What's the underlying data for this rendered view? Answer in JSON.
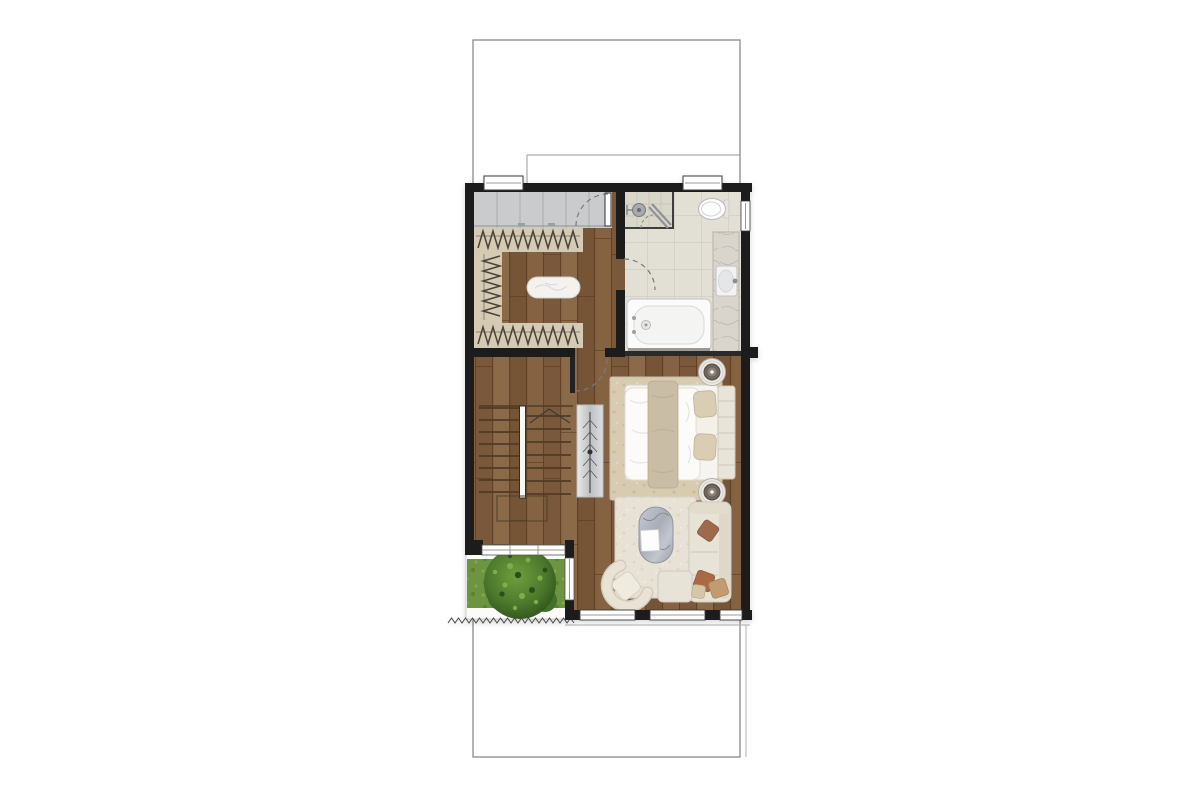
{
  "page": {
    "background": "#ffffff",
    "kind": "architectural-floor-plan",
    "floor": "upper-floor"
  },
  "palette": {
    "boundary_line": "#8a8a8a",
    "wall": "#1f1f1f",
    "wood_floor": "#7f5e3e",
    "tile_floor": "#e2dfd5",
    "tile_grout": "#c9c5b7",
    "wardrobe_gray": "#c9cbcd",
    "rack_beige": "#d5cbb4",
    "hanger_dark": "#4a4338",
    "grass": "#6d9440",
    "tree_green": "#4d7a2c",
    "rug_bedroom": "#d7cbb0",
    "rug_living": "#e8e2d6",
    "upholstery_cream": "#e8e3d7",
    "pillow_terracotta": "#a8765a",
    "pillow_tan": "#c29b72",
    "marble_gray": "#b3b7bf",
    "fixture_white": "#fbfbfb",
    "door_arc": "#7a7a7a"
  },
  "floor_plan": {
    "boundary": {
      "shape": "property-line-rectangle",
      "stroke": "#8a8a8a"
    },
    "rooms": [
      {
        "name": "walk-in-closet",
        "floor": "wood",
        "furniture": [
          "wardrobe-cabinet",
          "hanging-rail-top",
          "hanging-rail-left",
          "hanging-rail-bottom",
          "ottoman-bench"
        ]
      },
      {
        "name": "bathroom",
        "floor": "tile",
        "furniture": [
          "shower",
          "toilet",
          "vanity-sink",
          "bathtub"
        ]
      },
      {
        "name": "bedroom",
        "floor": "wood",
        "furniture": [
          "area-rug",
          "double-bed",
          "headboard",
          "side-table-top",
          "side-table-bottom"
        ]
      },
      {
        "name": "stair-hall",
        "floor": "wood",
        "furniture": [
          "u-shaped-staircase",
          "console-table"
        ]
      },
      {
        "name": "balcony-garden",
        "floor": "grass",
        "furniture": [
          "tree",
          "planter-strip"
        ]
      },
      {
        "name": "living-corner",
        "floor": "wood",
        "furniture": [
          "shaggy-rug",
          "marble-coffee-table",
          "l-shaped-sofa",
          "armchair",
          "throw-pillows"
        ]
      }
    ],
    "doors": [
      {
        "name": "closet-entry-door",
        "type": "swing"
      },
      {
        "name": "bathroom-door",
        "type": "swing"
      },
      {
        "name": "hall-door",
        "type": "swing"
      },
      {
        "name": "shower-glass-door",
        "type": "sliding-glass"
      }
    ],
    "windows": [
      {
        "name": "top-window-left"
      },
      {
        "name": "top-window-right"
      },
      {
        "name": "side-window-bathroom"
      },
      {
        "name": "balcony-glazing-band"
      },
      {
        "name": "balcony-divider-window"
      },
      {
        "name": "bottom-window-1"
      },
      {
        "name": "bottom-window-2"
      },
      {
        "name": "bottom-window-3"
      }
    ]
  }
}
